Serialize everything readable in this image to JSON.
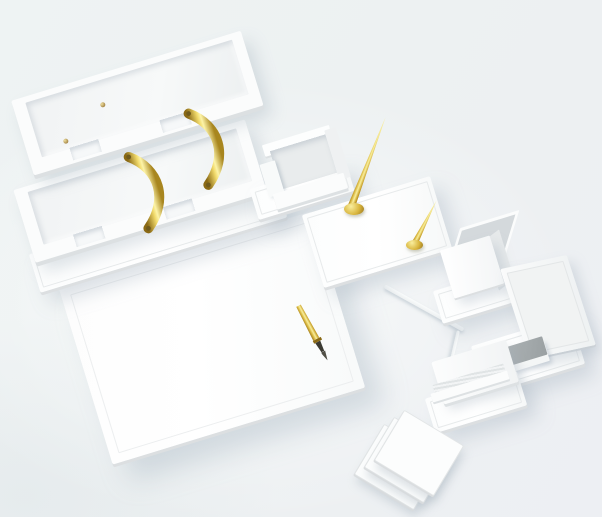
{
  "meta": {
    "category": "product-photo",
    "subject": "White leather desk organizer set with gold accents on a plain light studio backdrop"
  },
  "palette": {
    "backdrop": "#edf1f3",
    "item_white": "#fbfcfc",
    "edge_shadow": "#dcdfe1",
    "recess_gray": "#e9eced",
    "cup_interior": "#d4d9dc",
    "notepad_gray": "#a4aaac",
    "gold": "#d4af37",
    "gold_highlight": "#f7ec9e",
    "gold_deep": "#8a6914",
    "nib_black": "#3b3a32"
  },
  "scene": {
    "items": [
      {
        "label": "Two-tier document tray with curved gold handles",
        "tiers": 2,
        "handles": 2
      },
      {
        "label": "Leather desk pad blotter with stitched inner border"
      },
      {
        "label": "Gold fountain pen resting on the desk pad"
      },
      {
        "label": "Memo paper holder on base"
      },
      {
        "label": "Pen stand base with two gold desk pens"
      },
      {
        "label": "Tall gold desk pen"
      },
      {
        "label": "Short gold desk pen"
      },
      {
        "label": "Square pen cup on base"
      },
      {
        "label": "Ruler"
      },
      {
        "label": "Letter opener"
      },
      {
        "label": "Easel photo and memo stand"
      },
      {
        "label": "Gray notepad on stand base"
      },
      {
        "label": "Letter and business card holder"
      },
      {
        "label": "Stack of three square coasters",
        "count": 3
      }
    ]
  }
}
